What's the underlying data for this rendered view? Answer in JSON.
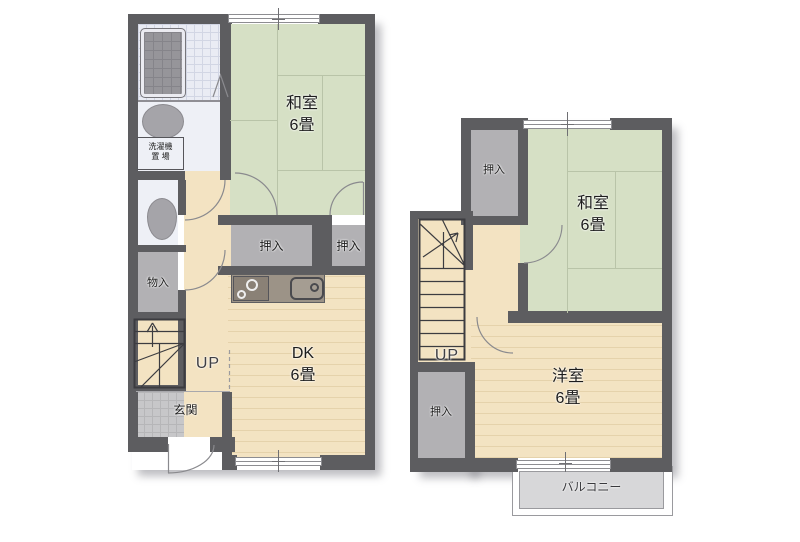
{
  "plans": {
    "floor1": {
      "rooms": {
        "washitsu": {
          "name": "和室",
          "size": "6畳"
        },
        "dk": {
          "name": "DK",
          "size": "6畳"
        },
        "closet_left": "押入",
        "closet_right": "押入",
        "storage": "物入",
        "entrance": "玄関",
        "stairs": "UP",
        "laundry_line1": "洗濯機",
        "laundry_line2": "置 場"
      }
    },
    "floor2": {
      "rooms": {
        "washitsu": {
          "name": "和室",
          "size": "6畳"
        },
        "western": {
          "name": "洋室",
          "size": "6畳"
        },
        "closet_top": "押入",
        "closet_bottom": "押入",
        "stairs": "UP",
        "balcony": "バルコニー"
      }
    }
  },
  "colors": {
    "wall": "#5d5d60",
    "tatami_green": "#d6e0c5",
    "wood_beige": "#f3e3c2",
    "closet_gray": "#b2b1b4",
    "tile_gray": "#c7c7c9",
    "bath_tile": "#eaecf4",
    "balcony_gray": "#d7d7d9"
  }
}
